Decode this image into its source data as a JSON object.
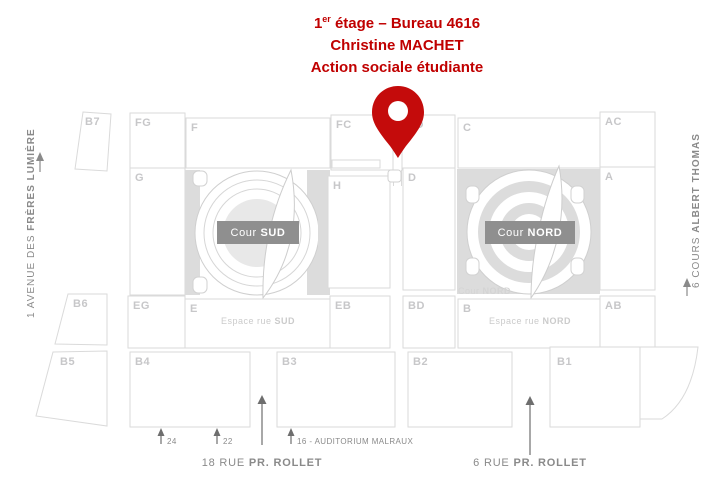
{
  "header": {
    "degree_num": "1",
    "degree_sup": "er",
    "line1_rest": " étage – Bureau 4616",
    "line2": "Christine MACHET",
    "line3": "Action sociale étudiante"
  },
  "colors": {
    "accent_red": "#C00000",
    "pin_red": "#C40B0B",
    "badge_gray": "#8F8F8F",
    "courtyard_gray": "#DCDCDC",
    "outline_gray": "#DADADA",
    "block_label_gray": "#C7C7C9",
    "street_gray": "#8A8A8A"
  },
  "map": {
    "blocks": {
      "b7": "B7",
      "fg": "FG",
      "f": "F",
      "fc": "FC",
      "cd": "CD",
      "c": "C",
      "ac": "AC",
      "g": "G",
      "h": "H",
      "d": "D",
      "a": "A",
      "b6": "B6",
      "eg": "EG",
      "e": "E",
      "eb": "EB",
      "bd": "BD",
      "b": "B",
      "ab": "AB",
      "b5": "B5",
      "b4": "B4",
      "b3": "B3",
      "b2": "B2",
      "b1": "B1"
    },
    "courtyards": {
      "sud": {
        "prefix": "Cour ",
        "name": "SUD"
      },
      "nord": {
        "prefix": "Cour ",
        "name": "NORD"
      },
      "nord_note": {
        "prefix": "Cour ",
        "name": "NORD"
      }
    },
    "espaces": {
      "sud": {
        "prefix": "Espace rue ",
        "name": "SUD"
      },
      "nord": {
        "prefix": "Espace rue ",
        "name": "NORD"
      }
    }
  },
  "streets": {
    "left": {
      "prefix": "1 AVENUE DES ",
      "name": "FRÈRES LUMIÈRE"
    },
    "right": {
      "prefix": "6 COURS ",
      "name": "ALBERT THOMAS"
    },
    "bottom_left": {
      "prefix": "18 RUE ",
      "name": "PR. ROLLET"
    },
    "bottom_right": {
      "prefix": "6 RUE ",
      "name": "PR. ROLLET"
    }
  },
  "entrances": {
    "n24": "24",
    "n22": "22",
    "n16": "16 - AUDITORIUM MALRAUX"
  }
}
